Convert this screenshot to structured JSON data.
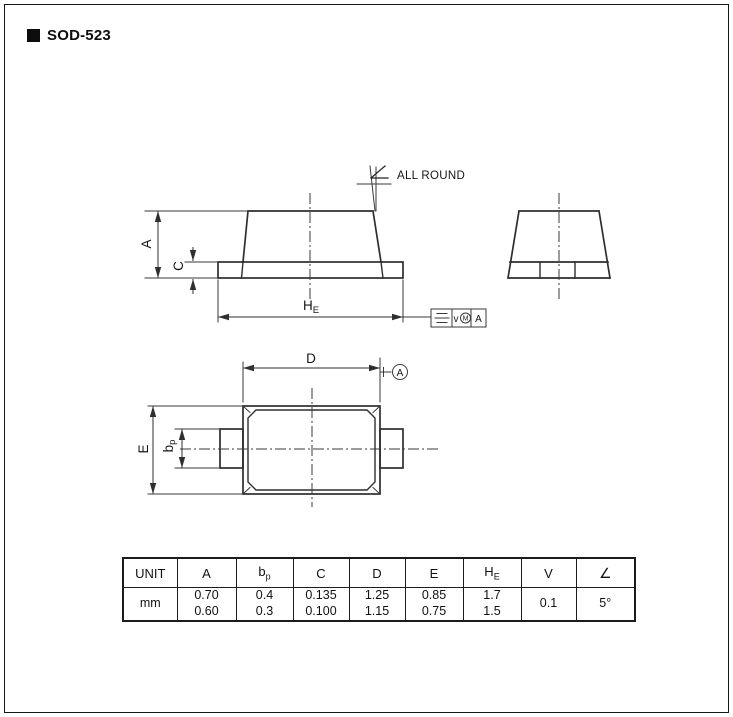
{
  "title": {
    "bullet_icon": "black-square",
    "text": "SOD-523"
  },
  "drawing": {
    "labels": {
      "dim_a": "A",
      "dim_c": "C",
      "dim_he_main": "H",
      "dim_he_sub": "E",
      "dim_d": "D",
      "dim_e": "E",
      "dim_bp_main": "b",
      "dim_bp_sub": "p",
      "all_round": "ALL ROUND"
    },
    "datum": {
      "label": "A"
    },
    "fcf": {
      "symbol_icon": "symmetry-tolerance",
      "tolerance_var": "v",
      "modifier": "M",
      "datum_ref": "A"
    }
  },
  "table": {
    "columns": [
      {
        "main": "UNIT",
        "sub": ""
      },
      {
        "main": "A",
        "sub": ""
      },
      {
        "main": "b",
        "sub": "p"
      },
      {
        "main": "C",
        "sub": ""
      },
      {
        "main": "D",
        "sub": ""
      },
      {
        "main": "E",
        "sub": ""
      },
      {
        "main": "H",
        "sub": "E"
      },
      {
        "main": "V",
        "sub": ""
      },
      {
        "main": "∠",
        "sub": ""
      }
    ],
    "values": [
      "mm",
      "0.70\n0.60",
      "0.4\n0.3",
      "0.135\n0.100",
      "1.25\n1.15",
      "0.85\n0.75",
      "1.7\n1.5",
      "0.1",
      "5°"
    ]
  }
}
